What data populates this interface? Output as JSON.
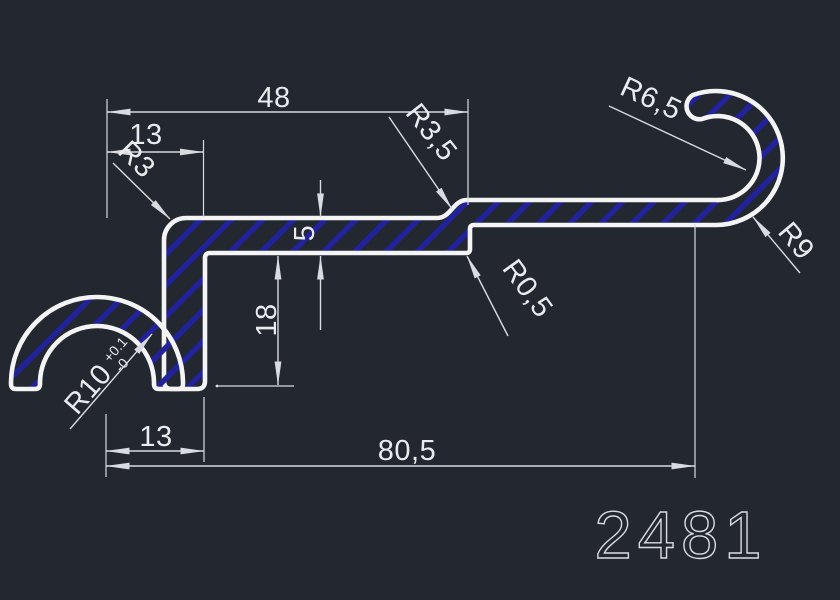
{
  "drawing": {
    "part_number": "2481",
    "dimensions": {
      "top_width": "48",
      "top_left_width": "13",
      "flange_thickness": "5",
      "leg_height": "18",
      "bottom_left_width": "13",
      "overall_width": "80,5"
    },
    "radius_labels": {
      "r3": "R3",
      "r3_5": "R3,5",
      "r0_5": "R0,5",
      "r6_5": "R6,5",
      "r9": "R9",
      "r10": "R10",
      "r10_tol_plus": "+0.1",
      "r10_tol_minus": "-0"
    },
    "colors": {
      "bg": "#222730",
      "line": "#f4f4f4",
      "dim": "#d8dbe0",
      "text": "#e9ebee",
      "hatch": "#22229c"
    }
  }
}
